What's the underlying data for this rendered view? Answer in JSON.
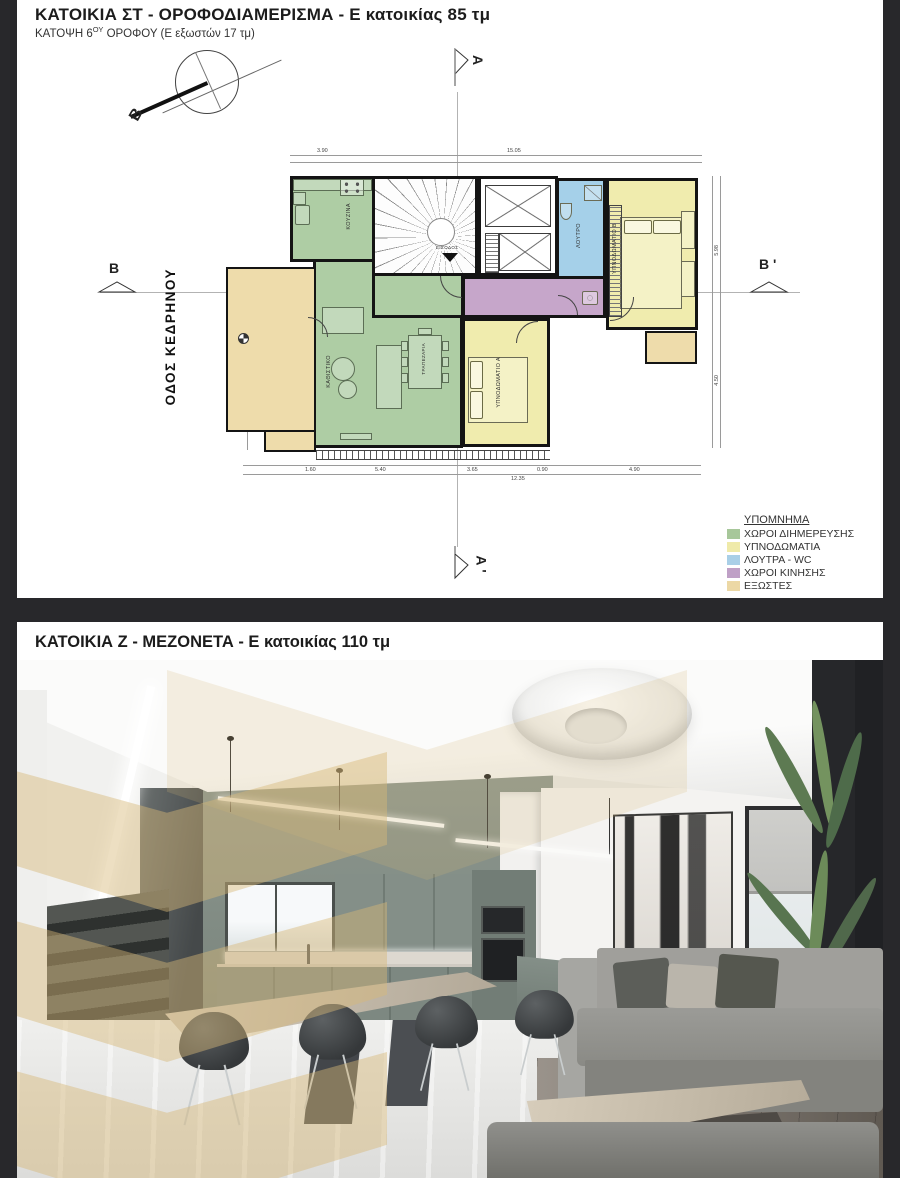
{
  "top_panel": {
    "title": "ΚΑΤΟΙΚΙΑ ΣΤ - ΟΡΟΦΟΔΙΑΜΕΡΙΣΜΑ - Ε κατοικίας 85 τμ",
    "subtitle_prefix": "ΚΑΤΟΨΗ 6",
    "subtitle_sup": "ΟΥ",
    "subtitle_suffix": " ΟΡΟΦΟΥ (Ε εξωστών 17 τμ)"
  },
  "bottom_panel": {
    "title": "ΚΑΤΟΙΚΙΑ Ζ - ΜΕΖΟΝΕΤΑ - Ε κατοικίας 110 τμ"
  },
  "plan": {
    "street_label": "ΟΔΟΣ ΚΕΔΡΗΝΟΥ",
    "north_label": "Β",
    "markers": {
      "top": "Α",
      "bottom": "Α '",
      "left": "Β",
      "right": "Β '"
    },
    "rooms": {
      "kitchen": "ΚΟΥΖΙΝΑ",
      "living": "ΚΑΘΙΣΤΙΚΟ",
      "dining": "ΤΡΑΠΕΖΑΡΙΑ",
      "bedroom_a": "ΥΠΝΟΔΩΜΑΤΙΟ Α",
      "bedroom_b": "ΥΠΝΟΔΩΜΑΤΙΟ Β",
      "bath": "ΛΟΥΤΡΟ",
      "entrance": "ΕΙΣΟΔΟΣ"
    },
    "colors": {
      "living_areas": "#aecda4",
      "bedrooms": "#f0ecae",
      "bath_wc": "#a5d0e9",
      "circulation": "#c6a6ca",
      "balconies": "#eedcab",
      "walls": "#141414"
    },
    "dims": {
      "top": [
        "3.90",
        "15.05"
      ],
      "bottom": [
        "1.60",
        "5.40",
        "3.65",
        "0.90",
        "4.90"
      ],
      "bottom_total": "12.35",
      "right": [
        "5.98",
        "4.50"
      ],
      "left": [
        "2.75",
        "3.40",
        "2.50",
        "1.60"
      ]
    }
  },
  "legend": {
    "title": "ΥΠΟΜΝΗΜΑ",
    "items": [
      {
        "label": "ΧΩΡΟΙ ΔΙΗΜΕΡΕΥΣΗΣ",
        "color": "#a7c79a"
      },
      {
        "label": "ΥΠΝΟΔΩΜΑΤΙΑ",
        "color": "#efeaa9"
      },
      {
        "label": "ΛΟΥΤΡΑ - WC",
        "color": "#a9cfe7"
      },
      {
        "label": "ΧΩΡΟΙ ΚΙΝΗΣΗΣ",
        "color": "#bfa0c6"
      },
      {
        "label": "ΕΞΩΣΤΕΣ",
        "color": "#ecd8a5"
      }
    ]
  },
  "render_colors": {
    "watermark": "#d8b977",
    "kitchen_wall": "#87918b",
    "cabinets": "#7b867e",
    "sofa": "#9b9b97"
  }
}
